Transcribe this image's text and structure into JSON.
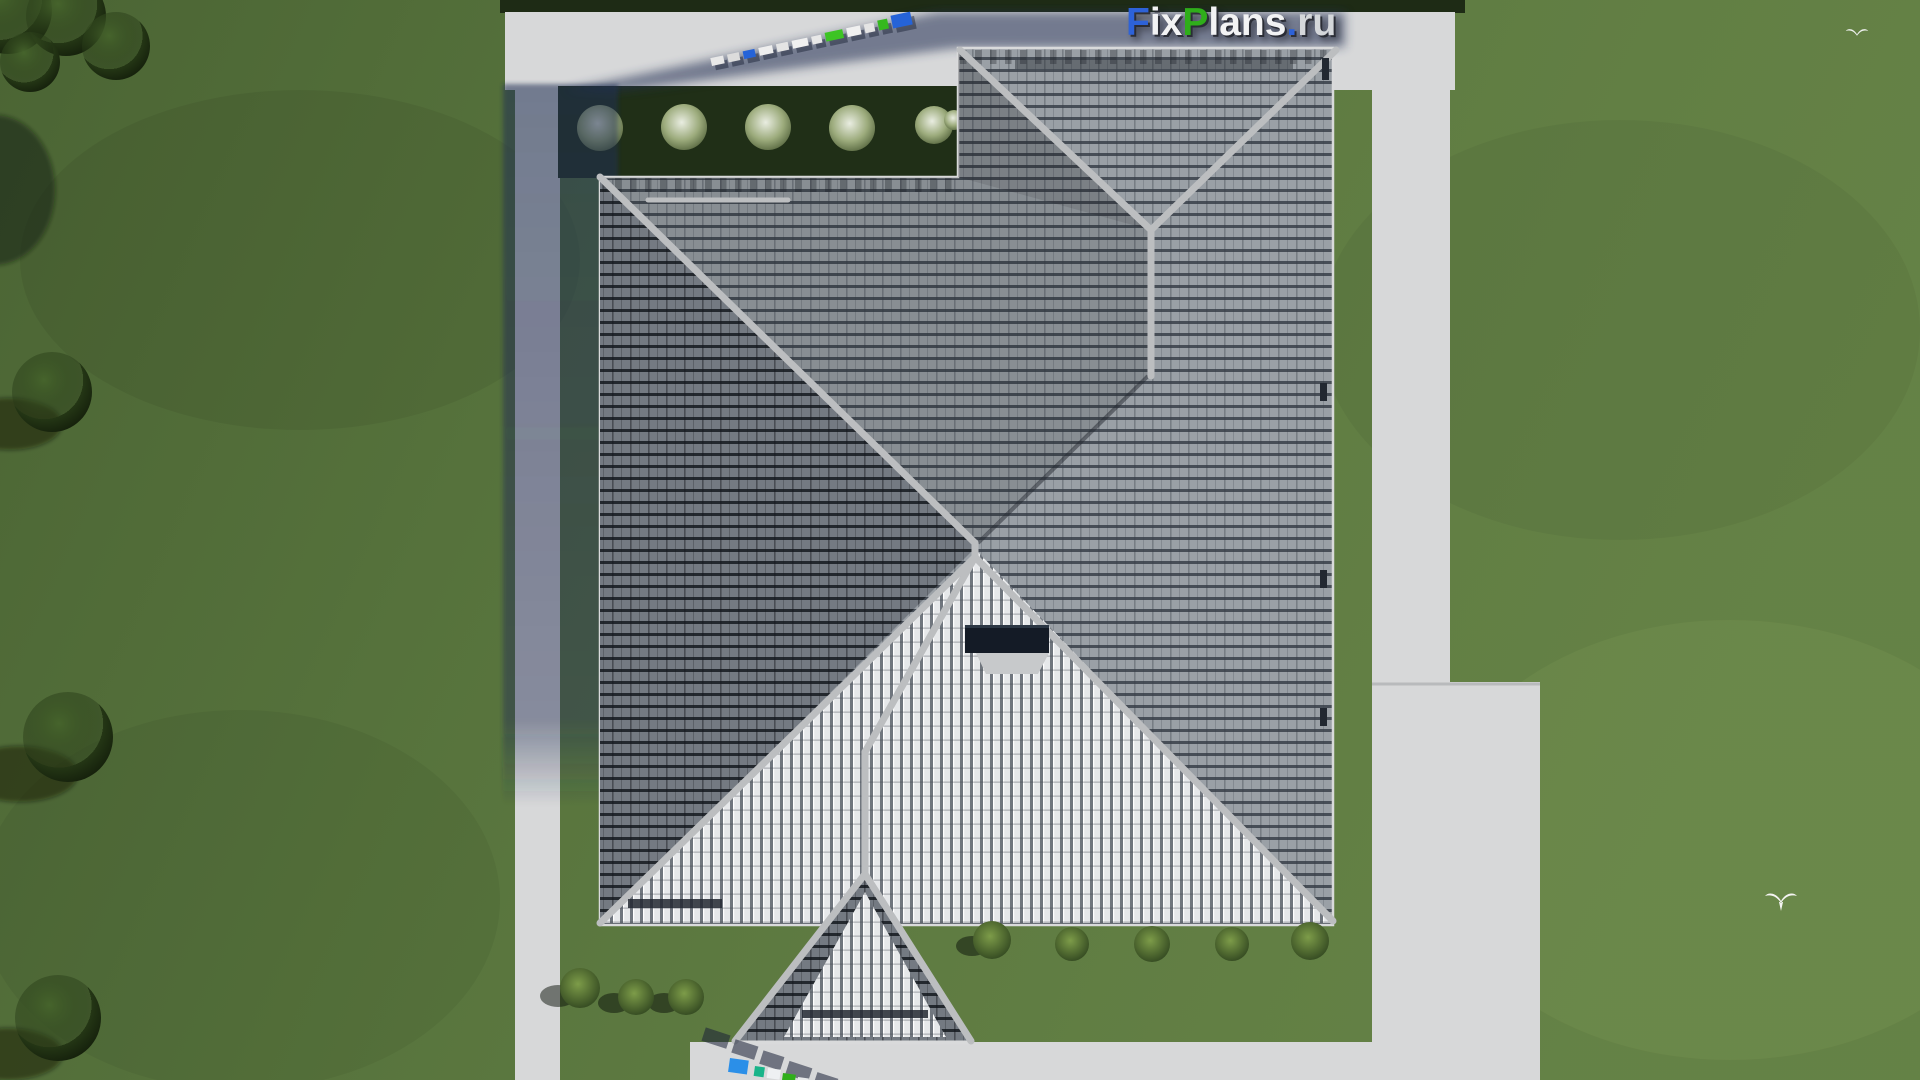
{
  "watermark": {
    "brand": "FixPlans.ru",
    "segments": [
      {
        "text": "F",
        "css": "color:#2d62d8"
      },
      {
        "text": "ix",
        "css": "color:#f2f3f4"
      },
      {
        "text": "P",
        "css": "color:#2fae1a"
      },
      {
        "text": "lans",
        "css": "color:#f2f3f4"
      },
      {
        "text": ".",
        "css": "color:#2d62d8"
      },
      {
        "text": "ru",
        "css": "color:#d4d7da"
      }
    ]
  },
  "scene": {
    "view": "top-down 3D architectural render",
    "house": "gray tiled hip roof with rear wing and front porch gable",
    "ground": "green lawn with concrete walkways and patio",
    "icons": [
      "bird-icon"
    ],
    "bird_count": 2
  },
  "colors": {
    "lawn": "#5d7b41",
    "path": "#d7d8d9",
    "roof_base": "#9aa0a6",
    "roof_dark": "#757b83",
    "roof_bright": "#e6e8ea",
    "ridge": "#bcbec0",
    "hedge": "#202f17",
    "cast_shadow": "#222e52",
    "logo_blue": "#2d62d8",
    "logo_green": "#2fae1a",
    "chimney": "#141b26"
  }
}
